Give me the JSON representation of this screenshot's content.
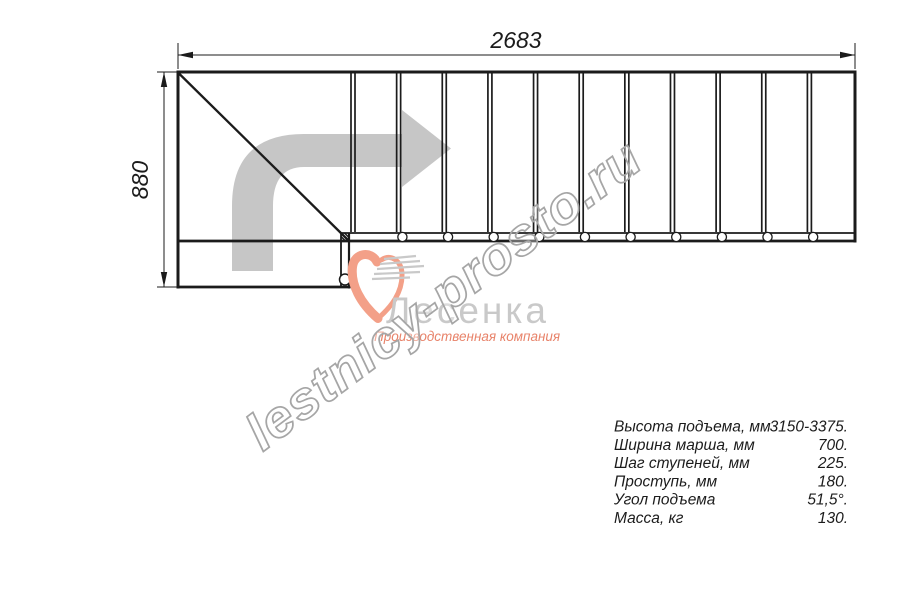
{
  "drawing": {
    "top_dimension": "2683",
    "left_dimension": "880",
    "tread_count": 11,
    "bolt_hole_count": 10,
    "line_color": "#1b1b1b",
    "route_arrow_color": "#c6c6c6"
  },
  "watermark": {
    "text": "lestnicy-prosto.ru",
    "outline_color": "#a6a6a6"
  },
  "logo": {
    "name": "Лесенка",
    "tagline": "Производственная компания",
    "accent_color": "#f3a088",
    "name_color": "#c9c9c9"
  },
  "specs": {
    "rows": [
      {
        "label": "Высота подъема, мм",
        "value": "3150-3375."
      },
      {
        "label": "Ширина марша, мм",
        "value": "700."
      },
      {
        "label": "Шаг ступеней, мм",
        "value": "225."
      },
      {
        "label": "Проступь, мм",
        "value": "180."
      },
      {
        "label": "Угол подъема",
        "value": "51,5°."
      },
      {
        "label": "Масса, кг",
        "value": "130."
      }
    ]
  }
}
